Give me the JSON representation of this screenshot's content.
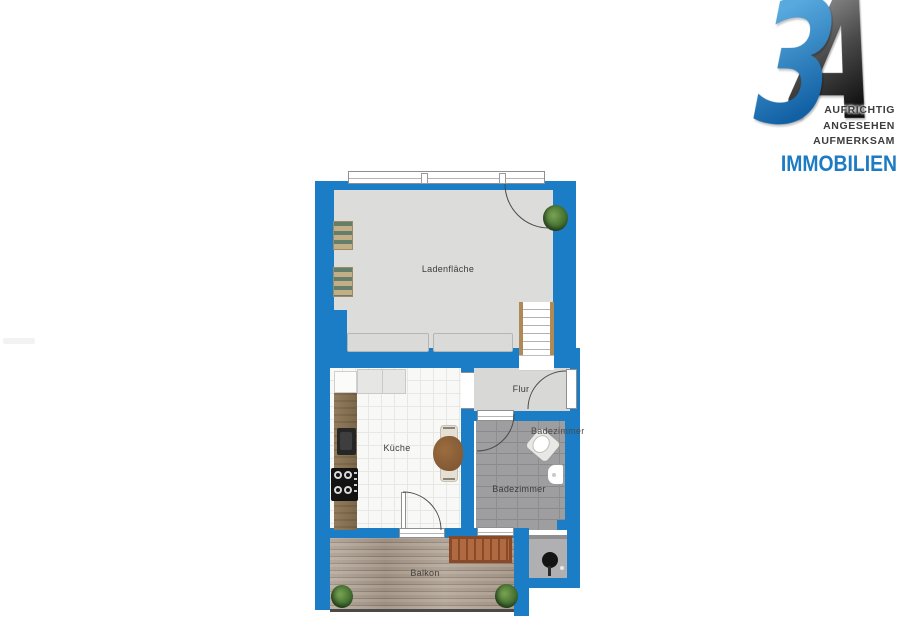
{
  "logo": {
    "monogram": {
      "digit": "3",
      "letter": "A"
    },
    "tagline": [
      "AUFRICHTIG",
      "ANGESEHEN",
      "AUFMERKSAM"
    ],
    "brand": "IMMOBILIEN",
    "colors": {
      "brand_blue": "#1d7bc3",
      "monogram_blue": "#1160a4",
      "monogram_dark": "#0d0d0d"
    }
  },
  "floorplan": {
    "labels": {
      "laden": "Ladenfläche",
      "flur": "Flur",
      "kueche": "Küche",
      "bad": "Badezimmer",
      "bad_secondary": "Badezimmer",
      "balkon": "Balkon"
    },
    "colors": {
      "wall": "#1b7dc6",
      "laden_floor": "#dcdcda",
      "flur_floor": "#d8d8d6",
      "kueche_floor": "#f8f8f6",
      "bad_floor": "#9e9ea1",
      "balkon_deck": "#a89a8c"
    },
    "objects": [
      "display-shelf",
      "display-shelf",
      "plant",
      "entrance-door",
      "storefront-window",
      "sales-counter",
      "sales-counter",
      "staircase",
      "fridge",
      "kitchen-cabinets",
      "kitchen-counter",
      "kitchen-sink",
      "stove",
      "dining-table",
      "dining-bench",
      "room-door",
      "toilet",
      "washbasin",
      "shower",
      "balcony-table",
      "plant",
      "plant"
    ]
  }
}
